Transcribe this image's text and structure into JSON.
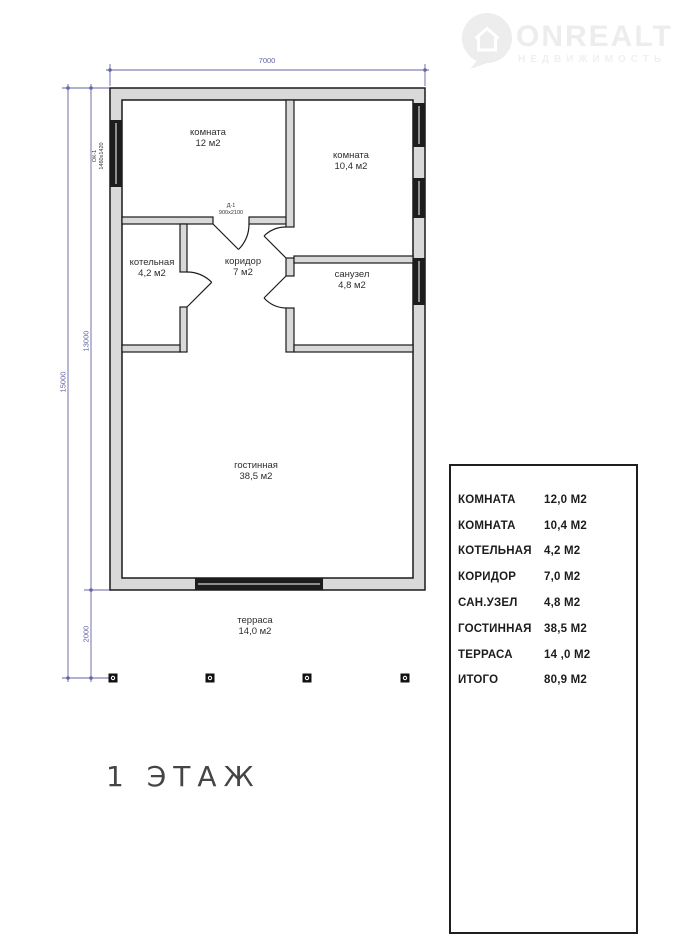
{
  "watermark": {
    "brand": "ONREALT",
    "subtitle": "НЕДВИЖИМОСТЬ",
    "color": "#ededed"
  },
  "floor_plan": {
    "title": "1 ЭТАЖ",
    "dimensions": {
      "top_width": "7000",
      "left_outer_height": "15000",
      "left_inner_height": "13000",
      "terrace_depth": "2000"
    },
    "door_label": {
      "code": "Д-1",
      "size": "900х2100"
    },
    "window_label": {
      "code": "ОК-1",
      "size": "1460х1420"
    },
    "rooms": [
      {
        "name": "комната",
        "area": "12 м2"
      },
      {
        "name": "комната",
        "area": "10,4 м2"
      },
      {
        "name": "котельная",
        "area": "4,2 м2"
      },
      {
        "name": "коридор",
        "area": "7 м2"
      },
      {
        "name": "санузел",
        "area": "4,8 м2"
      },
      {
        "name": "гостинная",
        "area": "38,5 м2"
      },
      {
        "name": "терраса",
        "area": "14,0 м2"
      }
    ],
    "colors": {
      "wall_outline": "#1a1a1a",
      "wall_fill": "#d9d9d9",
      "window_band": "#1d1d1d",
      "dimension": "#6363a3",
      "label_text": "#2e2e2e"
    }
  },
  "legend": {
    "rows": [
      {
        "label": "КОМНАТА",
        "value": "12,0 М2"
      },
      {
        "label": "КОМНАТА",
        "value": "10,4 М2"
      },
      {
        "label": "КОТЕЛЬНАЯ",
        "value": "4,2 М2"
      },
      {
        "label": "КОРИДОР",
        "value": "7,0 М2"
      },
      {
        "label": "САН.УЗЕЛ",
        "value": "4,8 М2"
      },
      {
        "label": "ГОСТИННАЯ",
        "value": "38,5 М2"
      },
      {
        "label": "ТЕРРАСА",
        "value": "14 ,0 М2"
      },
      {
        "label": "ИТОГО",
        "value": "80,9 М2"
      }
    ]
  }
}
